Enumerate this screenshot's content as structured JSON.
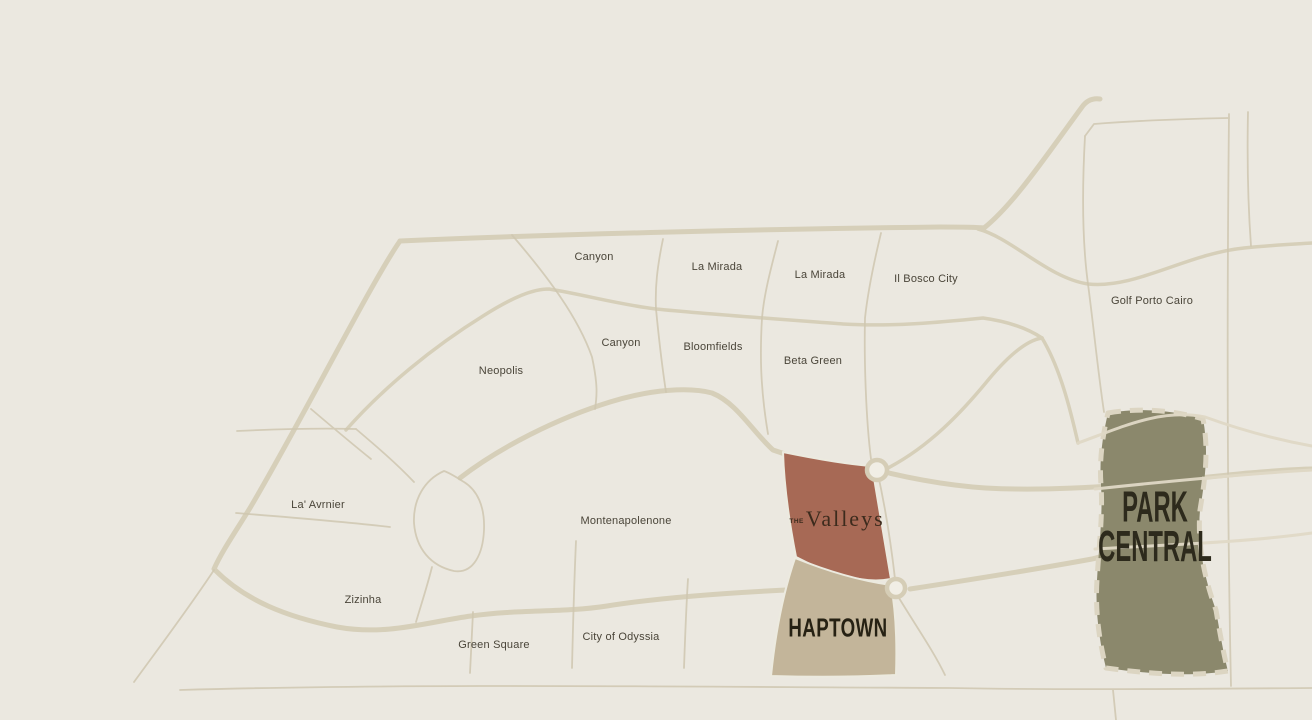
{
  "map": {
    "type": "real-estate masterplan location map",
    "colors": {
      "background": "#ebe8e0",
      "road": "#d6cfb9",
      "road_thin": "#cfc7b0",
      "road_over_area": "#e0d9c6",
      "label_text": "#4a4539",
      "valleys_fill": "#a76955",
      "valleys_text": "#3c2b1d",
      "haptown_fill": "#c3b59a",
      "haptown_text": "#262113",
      "park_central_fill": "#8b886c",
      "park_central_dash": "#dcd5c2",
      "park_central_text": "#2d2a1c",
      "junction_marker_ring": "#d5cdb6",
      "junction_marker_fill": "#f1eee5"
    },
    "area_labels": [
      "Canyon",
      "La Mirada",
      "La Mirada",
      "Il Bosco City",
      "Golf Porto Cairo",
      "Canyon",
      "Bloomfields",
      "Beta Green",
      "Neopolis",
      "La' Avrnier",
      "Montenapolenone",
      "Zizinha",
      "Green Square",
      "City of Odyssia"
    ],
    "projects": {
      "valleys": {
        "prefix": "THE",
        "name": "Valleys"
      },
      "haptown": {
        "name": "HAPTOWN"
      },
      "park_central": {
        "line1": "PARK",
        "line2": "CENTRAL"
      }
    },
    "junction_markers": 2
  }
}
